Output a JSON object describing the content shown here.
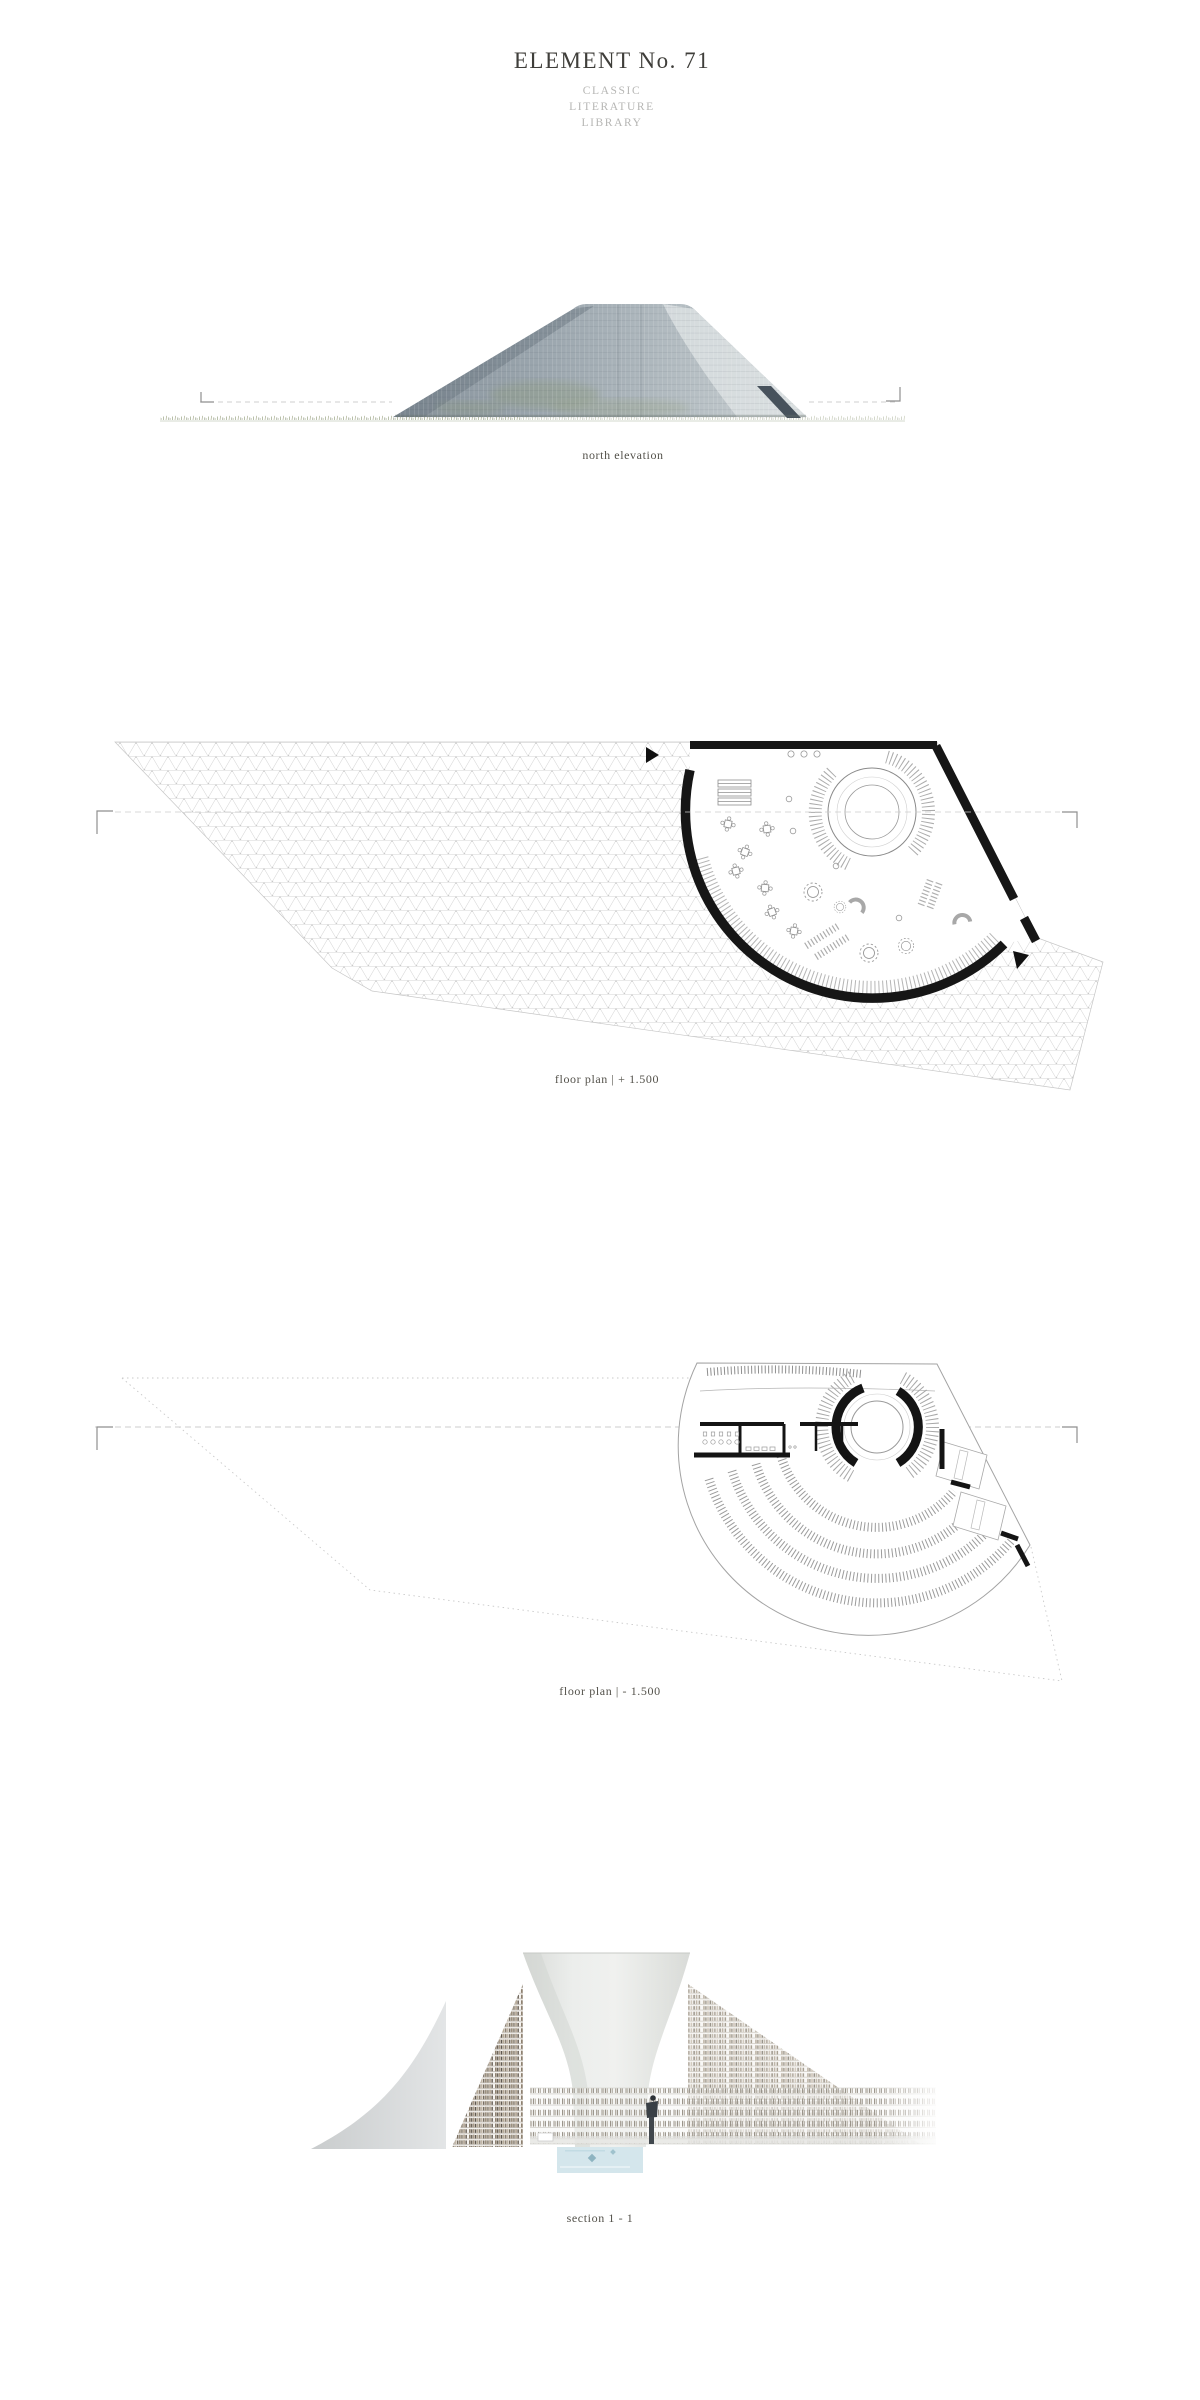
{
  "board": {
    "title": "ELEMENT No. 71",
    "subtitle_lines": [
      "CLASSIC",
      "LITERATURE",
      "LIBRARY"
    ]
  },
  "drawings": [
    {
      "name": "north-elevation",
      "caption": "north elevation"
    },
    {
      "name": "floor-plan-upper",
      "caption": "floor plan | + 1.500"
    },
    {
      "name": "floor-plan-lower",
      "caption": "floor plan | - 1.500"
    },
    {
      "name": "section-1-1",
      "caption": "section 1 - 1"
    }
  ],
  "colors": {
    "background": "#ffffff",
    "title_text": "#3f3e3a",
    "subtitle_text": "#b6b6b4",
    "caption_text": "#53514a",
    "plan_wall_black": "#161616",
    "mesh_line": "#d4d4d4",
    "guide_dash": "#cbcbcb",
    "facade_blue_gray": "#9aa5ad",
    "facade_door": "#47525c",
    "grass_green": "#9aa486",
    "book_tan": "#a89a88",
    "pool_blue": "#d4e6ec"
  }
}
